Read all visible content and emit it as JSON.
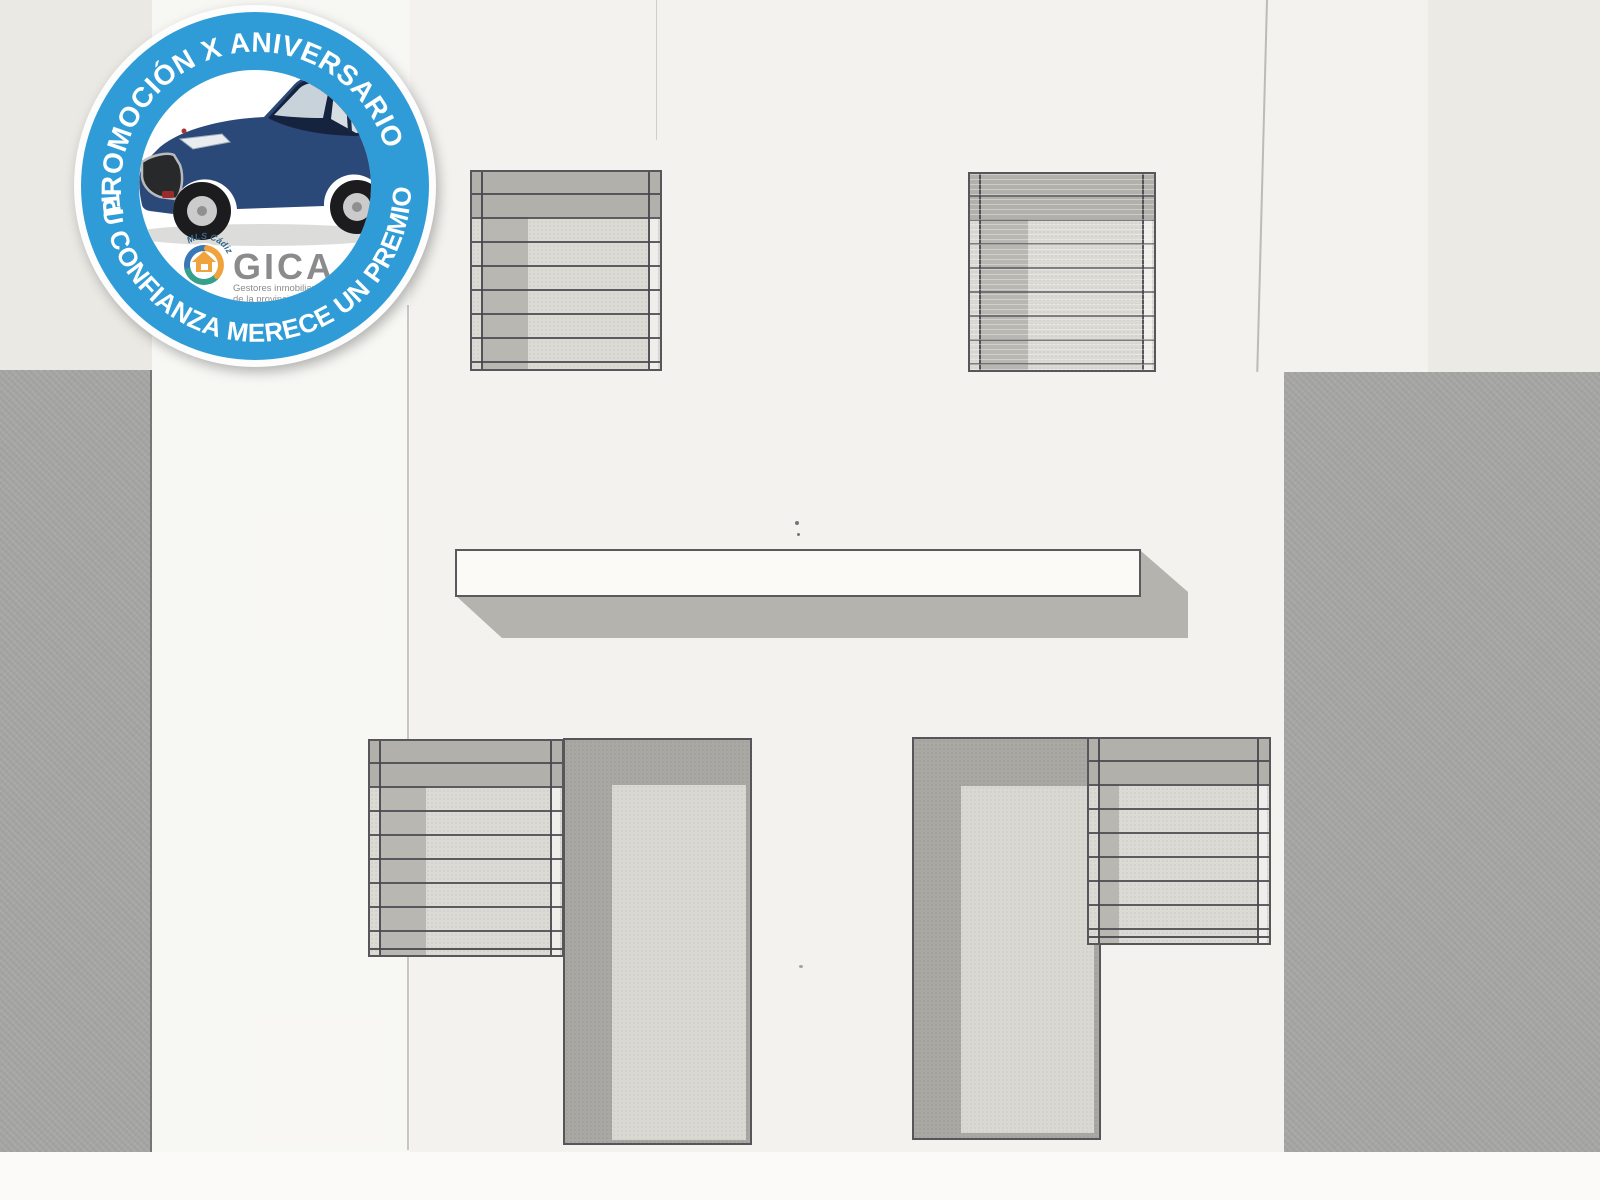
{
  "badge": {
    "ring_text_top": "PROMOCIÓN X ANIVERSARIO",
    "ring_text_bottom": "TU CONFIANZA MERECE UN PREMIO",
    "colors": {
      "ring_blue": "#2f9cd7",
      "ring_edge_white": "#fdfdfd",
      "car_body_blue": "#2a4878",
      "car_roof_blue": "#16233f"
    },
    "logo": {
      "wordmark": "GICA",
      "tagline_line1": "Gestores inmobiliarios",
      "tagline_line2": "de la provincia de Cádiz",
      "mls_label": "MLS Cádiz",
      "colors": {
        "wordmark_gray": "#8b8b8d",
        "icon_orange": "#f0a23c",
        "icon_teal": "#35a08c",
        "icon_blue": "#3a78b5",
        "mls_blue": "#33658a"
      }
    }
  },
  "drawing": {
    "description": "Scanned architectural facade elevation on folded paper",
    "colors": {
      "paper": "#f3f2ee",
      "side_wall_gray": "#a1a19f",
      "shutter_dark": "#b1b0ab",
      "shutter_light": "#dbdad5",
      "door_gray": "#a9a8a3",
      "door_panel": "#d9d8d3",
      "line": "#57575b",
      "ledge_white": "#fbfaf7",
      "ledge_shadow": "#b4b3ae"
    },
    "elements": [
      "upper-left shuttered window",
      "upper-right shuttered window",
      "balcony ledge with cast shadow",
      "lower-left shuttered window",
      "lower-left door leaf",
      "lower-right door leaf",
      "lower-right shuttered window"
    ]
  }
}
